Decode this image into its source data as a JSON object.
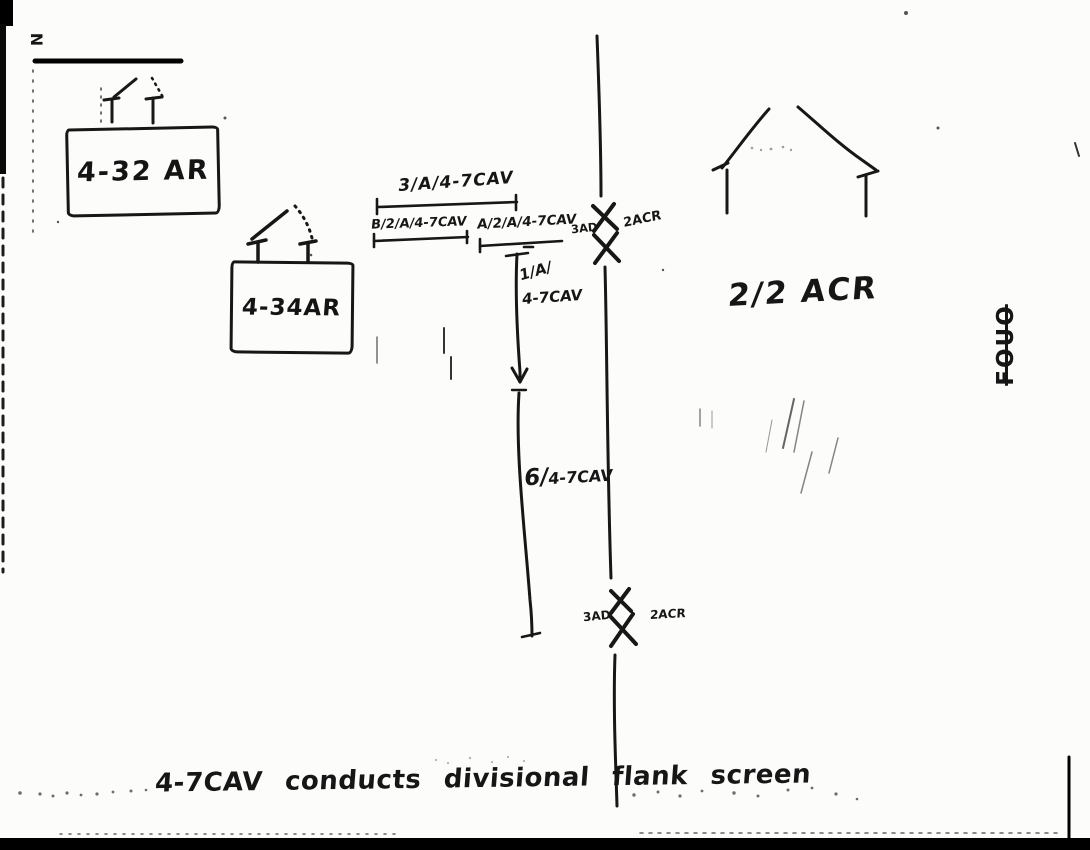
{
  "markers": {
    "north": "N",
    "watermark": "FOUO"
  },
  "units": {
    "armor_bn_1": "4-32 AR",
    "armor_bn_2": "4-34AR",
    "adjacent_regiment": "2/2 ACR"
  },
  "screen_elements": {
    "platoon_3a": "3/A/4-7CAV",
    "section_b2a": "B/2/A/4-7CAV",
    "section_a2a": "A/2/A/4-7CAV",
    "platoon_1a_prefix": "1/A/",
    "platoon_1a_unit": "4-7CAV",
    "element_6_prefix": "6/",
    "element_6_unit": "4-7CAV"
  },
  "boundaries": {
    "upper_left": "3AD",
    "upper_right": "2ACR",
    "lower_left": "3AD",
    "lower_right": "2ACR"
  },
  "caption": "4-7CAV conducts divisional flank screen",
  "ink_color": "#171717"
}
